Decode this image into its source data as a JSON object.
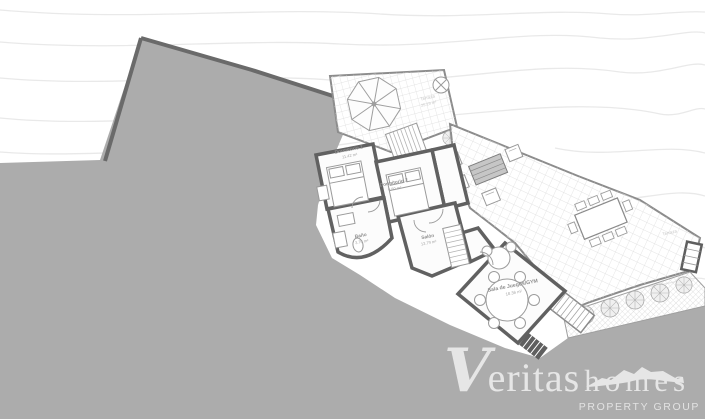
{
  "plan": {
    "rooms": [
      {
        "name": "Dormitorio 1",
        "area": "11.42 m²"
      },
      {
        "name": "Dormitorio 2",
        "area": "9.50 m²"
      },
      {
        "name": "Baño",
        "area": "3.70 m²"
      },
      {
        "name": "Salón",
        "area": "13.79 m²"
      },
      {
        "name": "Sala de Juegos/GYM",
        "area": "18.36 m²"
      }
    ],
    "terrace_top": {
      "name": "Terraza",
      "area": "25.19 m²"
    },
    "terrace_right": {
      "name": "Terraza"
    }
  },
  "watermark": {
    "brand_primary": "Veritas",
    "brand_secondary": "homes",
    "tagline": "PROPERTY GROUP"
  },
  "colors": {
    "terrain": "#acacac",
    "walls": "#616161",
    "tile_line": "#dedede",
    "contour": "#e9e9e9",
    "label": "#8f8f8f",
    "logo": "#e6e6e6"
  }
}
